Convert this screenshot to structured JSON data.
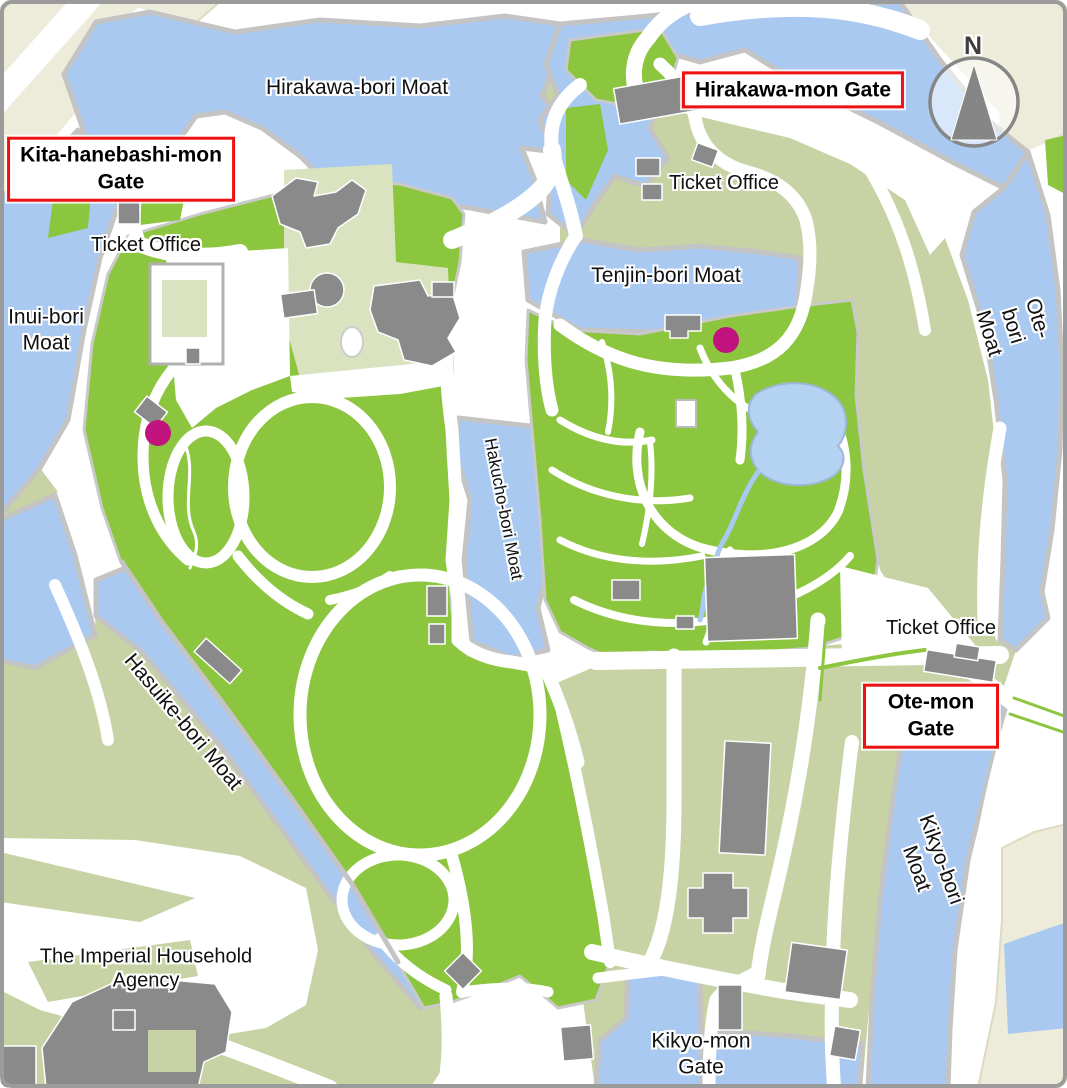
{
  "colors": {
    "water": "#A9C9F1",
    "pond": "#B4D2F2",
    "grass": "#8CC63F",
    "sage": "#C7D3A4",
    "lightgreen": "#D9E3C0",
    "beige": "#EDEBD9",
    "building": "#8A8A8A",
    "wall": "#C4C4C4",
    "road": "#FFFFFF",
    "marker": "#C0137E",
    "redbox": "#EE1111",
    "labelink": "#111111",
    "compass": "#868686",
    "frame": "#9B9B9B"
  },
  "compass": {
    "north_label": "N"
  },
  "gates": [
    {
      "name": "kita-hanebashi-mon-gate",
      "label": "Kita-hanebashi-mon\nGate"
    },
    {
      "name": "hirakawa-mon-gate",
      "label": "Hirakawa-mon Gate"
    },
    {
      "name": "ote-mon-gate",
      "label": "Ote-mon Gate"
    }
  ],
  "moats": [
    {
      "name": "hirakawa-bori-moat",
      "label": "Hirakawa-bori Moat"
    },
    {
      "name": "tenjin-bori-moat",
      "label": "Tenjin-bori Moat"
    },
    {
      "name": "inui-bori-moat",
      "label": "Inui-bori\nMoat"
    },
    {
      "name": "ote-bori-moat",
      "label": "Ote-bori Moat"
    },
    {
      "name": "hakucho-bori-moat",
      "label": "Hakucho-bori Moat"
    },
    {
      "name": "hasuike-bori-moat",
      "label": "Hasuike-bori Moat"
    },
    {
      "name": "kikyo-bori-moat",
      "label": "Kikyo-bori Moat"
    }
  ],
  "ticket_offices": [
    {
      "name": "ticket-office-northwest",
      "label": "Ticket Office"
    },
    {
      "name": "ticket-office-northeast",
      "label": "Ticket Office"
    },
    {
      "name": "ticket-office-east",
      "label": "Ticket Office"
    }
  ],
  "places": [
    {
      "name": "imperial-household-agency",
      "label": "The Imperial Household\nAgency"
    },
    {
      "name": "kikyo-mon-gate",
      "label": "Kikyo-mon\nGate"
    }
  ],
  "markers": [
    {
      "name": "point-marker-west"
    },
    {
      "name": "point-marker-east"
    }
  ]
}
